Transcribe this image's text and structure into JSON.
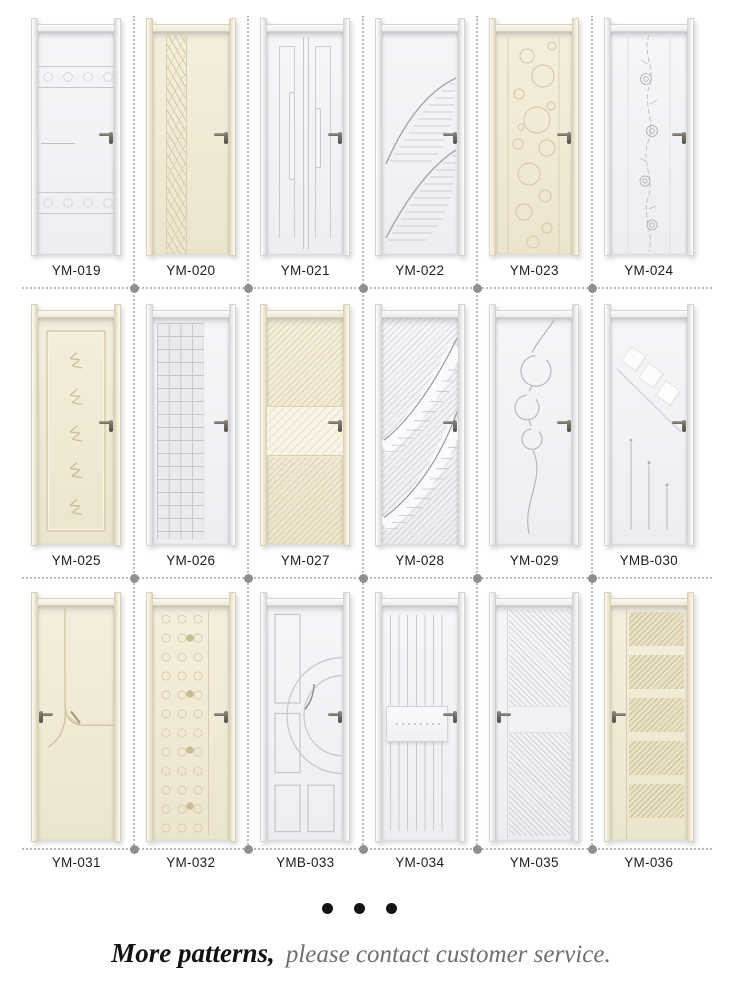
{
  "catalog": {
    "doors": [
      {
        "label": "YM-019",
        "finish": "white",
        "finish_color": "#f2f3f6",
        "handle_side": "right",
        "design": "carved scroll bands top and bottom with short middle groove"
      },
      {
        "label": "YM-020",
        "finish": "cream",
        "finish_color": "#f1ead7",
        "handle_side": "right",
        "design": "vertical braided ribbon strip on left"
      },
      {
        "label": "YM-021",
        "finish": "white",
        "finish_color": "#f2f3f6",
        "handle_side": "right",
        "design": "vertical grooved lines and slim bars"
      },
      {
        "label": "YM-022",
        "finish": "white",
        "finish_color": "#f2f3f6",
        "handle_side": "right",
        "design": "two sweeping curves with feathered line shading"
      },
      {
        "label": "YM-023",
        "finish": "cream",
        "finish_color": "#f1ead7",
        "handle_side": "right",
        "design": "bubble circles in center panel"
      },
      {
        "label": "YM-024",
        "finish": "white",
        "finish_color": "#f2f3f6",
        "handle_side": "right",
        "design": "climbing rose vine down the center"
      },
      {
        "label": "YM-025",
        "finish": "cream",
        "finish_color": "#f1ead7",
        "handle_side": "right",
        "design": "inset frame with five branch motifs"
      },
      {
        "label": "YM-026",
        "finish": "white",
        "finish_color": "#f2f3f6",
        "handle_side": "right",
        "design": "embossed square grid on left panel"
      },
      {
        "label": "YM-027",
        "finish": "cream",
        "finish_color": "#f1ead7",
        "handle_side": "right",
        "design": "diagonal weave with smooth center band"
      },
      {
        "label": "YM-028",
        "finish": "white",
        "finish_color": "#f2f3f6",
        "handle_side": "right",
        "design": "diagonal weave crossed by curved sweeps"
      },
      {
        "label": "YM-029",
        "finish": "white",
        "finish_color": "#f2f3f6",
        "handle_side": "right",
        "design": "wavy vine with three circles"
      },
      {
        "label": "YMB-030",
        "finish": "white",
        "finish_color": "#f2f3f6",
        "handle_side": "right",
        "design": "three tilted squares on a diagonal with three vertical lines"
      },
      {
        "label": "YM-031",
        "finish": "cream",
        "finish_color": "#f1ead7",
        "handle_side": "left",
        "design": "branching groove with arrow curve at middle"
      },
      {
        "label": "YM-032",
        "finish": "cream",
        "finish_color": "#f1ead7",
        "handle_side": "right",
        "design": "columns of embossed dots on left strip"
      },
      {
        "label": "YMB-033",
        "finish": "white",
        "finish_color": "#f2f3f6",
        "handle_side": "right",
        "design": "recessed panels with concentric arcs"
      },
      {
        "label": "YM-034",
        "finish": "white",
        "finish_color": "#f2f3f6",
        "handle_side": "right",
        "design": "vertical slats with carved center rail"
      },
      {
        "label": "YM-035",
        "finish": "white",
        "finish_color": "#f2f3f6",
        "handle_side": "left",
        "design": "two woven panels split by plain rail"
      },
      {
        "label": "YM-036",
        "finish": "cream",
        "finish_color": "#f1ead7",
        "handle_side": "left",
        "design": "five woven horizontal panels beside plain stile"
      }
    ]
  },
  "footer": {
    "dots_count": 3,
    "more_label": "More patterns,",
    "contact_text": "please contact customer service."
  },
  "colors": {
    "background": "#ffffff",
    "door_white": "#f2f3f6",
    "door_cream": "#f1ead7",
    "separator": "#bdbdc0",
    "node_dot": "#8e8f91",
    "label_text": "#1d1d1f",
    "footer_primary": "#121212",
    "footer_secondary": "#6f6f6f"
  }
}
